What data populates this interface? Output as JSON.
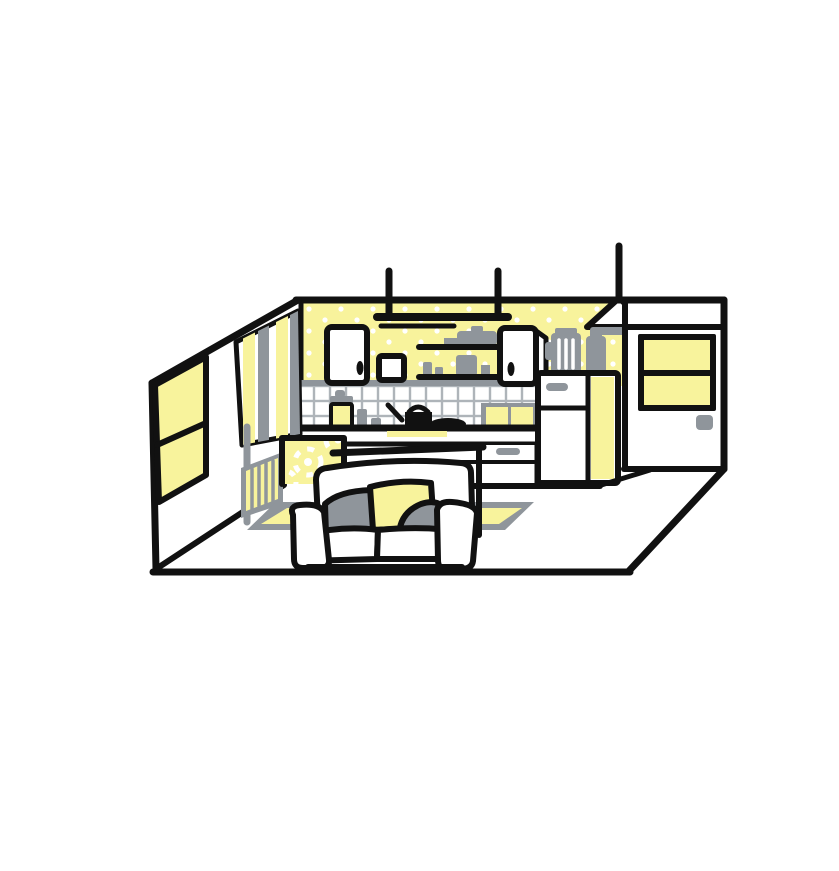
{
  "meta": {
    "title": "Flat line-art illustration of a studio interior: kitchen wall with yellow wallpaper, cabinets, shelves, fridge, pendant lamp, door, and a white sofa on a yellow rug",
    "style": "hand-drawn flat vector, black outlines, yellow and gray accents on white"
  },
  "colors": {
    "yellow": "#F8F39C",
    "gray": "#8F959B",
    "ink": "#111111",
    "grout": "#AEB4B9",
    "background": "#FFFFFF"
  },
  "scene": {
    "objects": [
      "left-wall-window",
      "striped-curtain",
      "wall-pipe",
      "radiator",
      "dotted-yellow-wallpaper",
      "ceiling-hanging-rack",
      "wall-shelf-upper",
      "wall-shelf-lower",
      "wall-cabinet-left",
      "spice-box",
      "wall-cabinet-right",
      "backsplash-tiles",
      "countertop",
      "cooktop-pan",
      "kettle",
      "yellow-canister",
      "gray-bottle",
      "under-counter-drawer",
      "mini-yellow-cabinet",
      "kitchen-island-flower-pattern",
      "refrigerator-yellow-side",
      "blender",
      "storage-jar",
      "pendant-lamp",
      "back-door-with-yellow-window",
      "door-handle",
      "yellow-rug",
      "console-table",
      "sofa",
      "pillow-gray-left",
      "pillow-yellow-center",
      "pillow-gray-right"
    ]
  }
}
